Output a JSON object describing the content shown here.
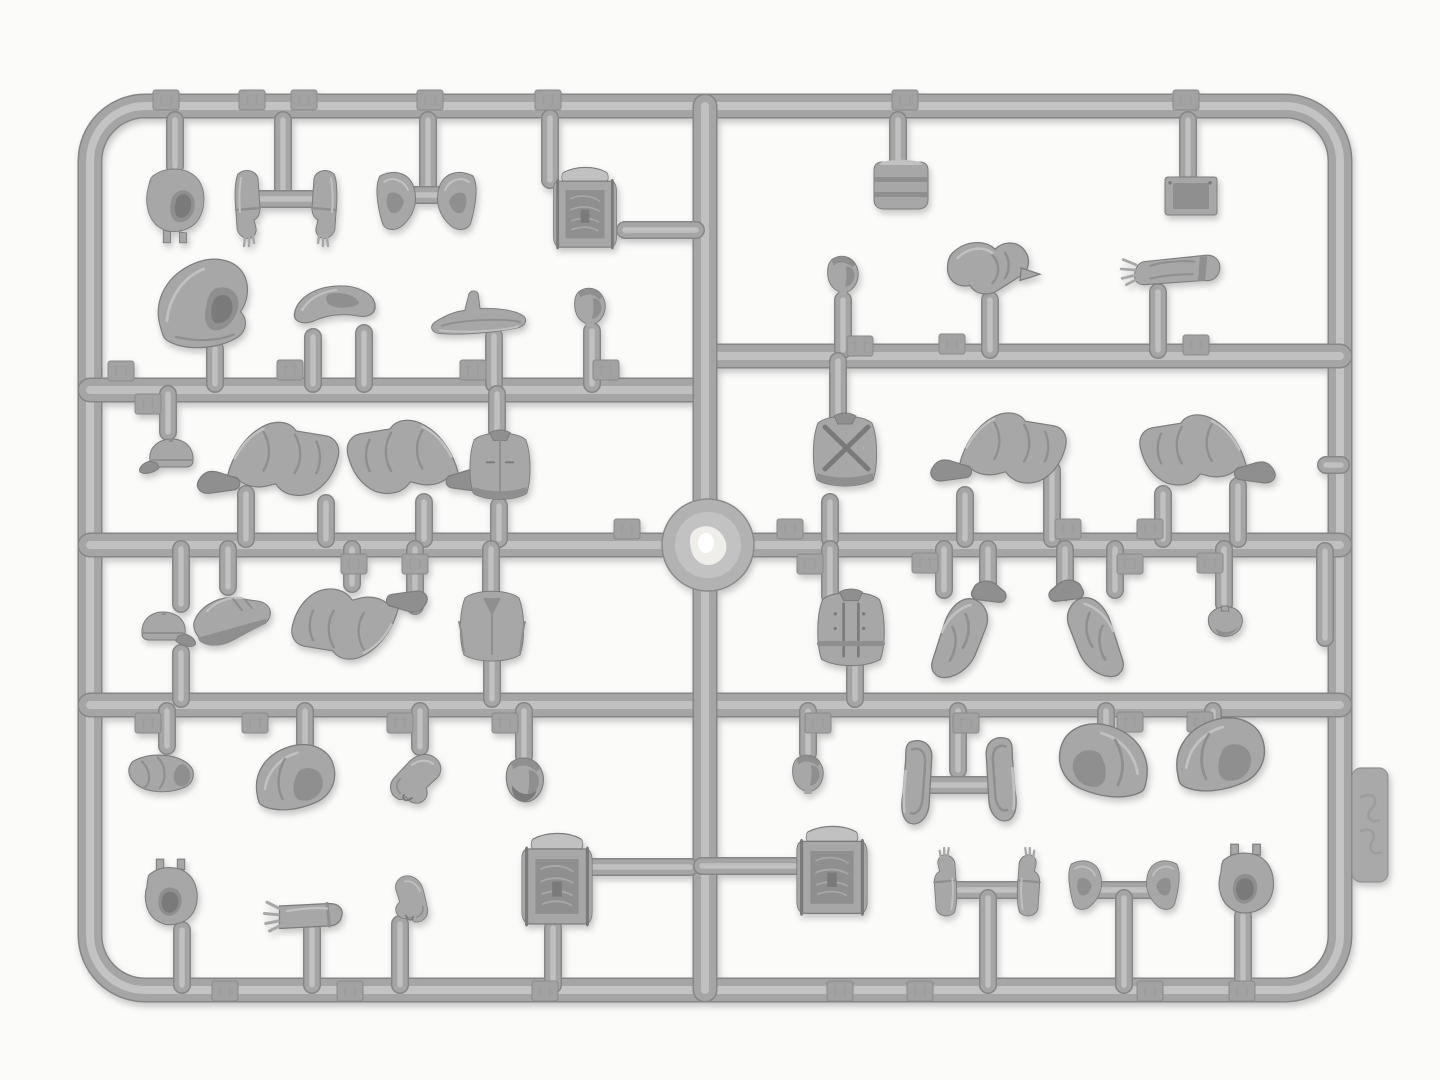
{
  "meta": {
    "alt": "Photograph of a gray injection-molded plastic model kit sprue holding miniature figure parts: balaclava heads, hoods, caps, arms, hands, bent legs, torsos, backpacks and equipment pieces, arranged in a rectangular runner frame on a white background",
    "subject": "plastic model kit parts sprue",
    "note": "embossed part-number tabs present on runners but digits are not legible in the photo"
  },
  "palette": {
    "background": "#fbfbfa",
    "bar_dark": "#868686",
    "bar_base": "#a5a5a5",
    "bar_light": "#c3c3c3",
    "part_base": "#a7a7a7",
    "part_shade": "#8f8f8f",
    "part_dark": "#7a7a7a",
    "part_light": "#c1c1c1",
    "part_outline": "#7c7c7c",
    "tab_fill": "#a2a2a2",
    "tab_edge": "#8a8a8a",
    "hub_fill": "#b2b2b2",
    "hub_ring": "#c2c2c2",
    "hub_bright": "#efeeea",
    "hub_white": "#ffffff",
    "side_tab_fill": "#a9a9a9",
    "side_tab_edge": "#919191",
    "emboss": "#9d9d9d"
  },
  "sprue": {
    "frame": {
      "x": 90,
      "y": 106,
      "w": 1250,
      "h": 884,
      "rx": 55,
      "bar_width": 22
    },
    "bars": [
      {
        "x1": 90,
        "y1": 390,
        "x2": 705,
        "y2": 390
      },
      {
        "x1": 705,
        "y1": 356,
        "x2": 1340,
        "y2": 356
      },
      {
        "x1": 90,
        "y1": 545,
        "x2": 1340,
        "y2": 545
      },
      {
        "x1": 90,
        "y1": 705,
        "x2": 1340,
        "y2": 705
      },
      {
        "x1": 705,
        "y1": 106,
        "x2": 705,
        "y2": 990
      }
    ],
    "hub": {
      "x": 708,
      "y": 545,
      "r": 46
    },
    "side_tab": {
      "x": 1352,
      "y": 768,
      "w": 36,
      "h": 114,
      "rx": 9
    },
    "stubs": [
      [
        175,
        120,
        175,
        166
      ],
      [
        283,
        120,
        283,
        197
      ],
      [
        245,
        199,
        323,
        199
      ],
      [
        428,
        120,
        428,
        192
      ],
      [
        396,
        195,
        458,
        195
      ],
      [
        550,
        118,
        550,
        180
      ],
      [
        625,
        230,
        696,
        230
      ],
      [
        215,
        349,
        215,
        384
      ],
      [
        313,
        337,
        313,
        384
      ],
      [
        364,
        333,
        364,
        384
      ],
      [
        494,
        336,
        494,
        384
      ],
      [
        592,
        331,
        592,
        384
      ],
      [
        898,
        120,
        898,
        160
      ],
      [
        1188,
        120,
        1188,
        174
      ],
      [
        843,
        300,
        843,
        350
      ],
      [
        990,
        300,
        990,
        350
      ],
      [
        1158,
        292,
        1158,
        350
      ],
      [
        168,
        394,
        168,
        432
      ],
      [
        497,
        394,
        497,
        431
      ],
      [
        246,
        494,
        246,
        539
      ],
      [
        326,
        503,
        326,
        539
      ],
      [
        424,
        502,
        424,
        539
      ],
      [
        499,
        506,
        499,
        539
      ],
      [
        838,
        361,
        838,
        416
      ],
      [
        830,
        502,
        830,
        539
      ],
      [
        965,
        495,
        965,
        539
      ],
      [
        1052,
        470,
        1052,
        539
      ],
      [
        1163,
        494,
        1163,
        539
      ],
      [
        1238,
        486,
        1238,
        539
      ],
      [
        1326,
        465,
        1341,
        465
      ],
      [
        181,
        549,
        181,
        604
      ],
      [
        181,
        653,
        181,
        699
      ],
      [
        228,
        549,
        228,
        587
      ],
      [
        352,
        549,
        352,
        584
      ],
      [
        415,
        549,
        415,
        606
      ],
      [
        491,
        549,
        491,
        597
      ],
      [
        492,
        659,
        492,
        699
      ],
      [
        830,
        549,
        830,
        596
      ],
      [
        855,
        663,
        855,
        699
      ],
      [
        944,
        549,
        944,
        590
      ],
      [
        988,
        549,
        988,
        592
      ],
      [
        1065,
        549,
        1065,
        592
      ],
      [
        1115,
        549,
        1115,
        590
      ],
      [
        1224,
        549,
        1224,
        604
      ],
      [
        1325,
        551,
        1325,
        638
      ],
      [
        167,
        711,
        167,
        746
      ],
      [
        305,
        711,
        305,
        750
      ],
      [
        420,
        711,
        420,
        747
      ],
      [
        524,
        711,
        524,
        756
      ],
      [
        182,
        930,
        182,
        985
      ],
      [
        312,
        929,
        312,
        985
      ],
      [
        400,
        924,
        400,
        985
      ],
      [
        553,
        928,
        553,
        985
      ],
      [
        592,
        867,
        690,
        867
      ],
      [
        808,
        711,
        808,
        753
      ],
      [
        958,
        711,
        958,
        770
      ],
      [
        930,
        785,
        988,
        785
      ],
      [
        1106,
        711,
        1106,
        740
      ],
      [
        1213,
        711,
        1213,
        737
      ],
      [
        702,
        866,
        795,
        866
      ],
      [
        958,
        890,
        1016,
        890
      ],
      [
        988,
        898,
        988,
        985
      ],
      [
        1098,
        890,
        1150,
        890
      ],
      [
        1124,
        898,
        1124,
        985
      ],
      [
        1243,
        916,
        1243,
        985
      ]
    ],
    "number_tabs": [
      [
        166,
        100
      ],
      [
        252,
        100
      ],
      [
        304,
        100
      ],
      [
        430,
        100
      ],
      [
        548,
        100
      ],
      [
        905,
        100
      ],
      [
        1186,
        100
      ],
      [
        121,
        371
      ],
      [
        290,
        370
      ],
      [
        473,
        370
      ],
      [
        606,
        370
      ],
      [
        148,
        404
      ],
      [
        860,
        346
      ],
      [
        952,
        344
      ],
      [
        1196,
        345
      ],
      [
        627,
        529
      ],
      [
        790,
        529
      ],
      [
        1068,
        529
      ],
      [
        1150,
        529
      ],
      [
        354,
        564
      ],
      [
        415,
        564
      ],
      [
        810,
        564
      ],
      [
        925,
        563
      ],
      [
        1130,
        564
      ],
      [
        1210,
        563
      ],
      [
        148,
        723
      ],
      [
        255,
        723
      ],
      [
        400,
        723
      ],
      [
        505,
        723
      ],
      [
        818,
        723
      ],
      [
        966,
        723
      ],
      [
        1130,
        722
      ],
      [
        1200,
        722
      ],
      [
        225,
        991
      ],
      [
        350,
        991
      ],
      [
        545,
        991
      ],
      [
        840,
        991
      ],
      [
        920,
        991
      ],
      [
        1150,
        991
      ],
      [
        1242,
        991
      ]
    ],
    "parts": [
      {
        "t": "balaclava",
        "x": 175,
        "y": 205,
        "s": 0.9,
        "label": "balaclava head"
      },
      {
        "t": "forearm",
        "x": 247,
        "y": 206,
        "label": "forearm with hand"
      },
      {
        "t": "forearm",
        "x": 325,
        "y": 206,
        "fx": 1,
        "label": "forearm with hand"
      },
      {
        "t": "gaiter",
        "x": 396,
        "y": 202,
        "label": "boot gaiter"
      },
      {
        "t": "gaiter",
        "x": 457,
        "y": 202,
        "fx": 1,
        "label": "boot gaiter"
      },
      {
        "t": "backpack",
        "x": 585,
        "y": 212,
        "sx": 0.72,
        "sy": 1.1,
        "label": "backpack"
      },
      {
        "t": "hood-big",
        "x": 206,
        "y": 307,
        "s": 1.15,
        "label": "hooded head"
      },
      {
        "t": "shoulder",
        "x": 336,
        "y": 306,
        "sx": 1.3,
        "sy": 1.0,
        "label": "shoulder yoke"
      },
      {
        "t": "saddle",
        "x": 480,
        "y": 318,
        "s": 0.95,
        "label": "saddle piece"
      },
      {
        "t": "head",
        "x": 590,
        "y": 308,
        "s": 0.95,
        "label": "head"
      },
      {
        "t": "drum",
        "x": 901,
        "y": 185,
        "label": "canteen drum"
      },
      {
        "t": "plate",
        "x": 1191,
        "y": 196,
        "label": "equipment plate"
      },
      {
        "t": "head",
        "x": 843,
        "y": 276,
        "s": 0.95,
        "label": "head"
      },
      {
        "t": "arm-point",
        "x": 995,
        "y": 273,
        "s": 1.25,
        "label": "pointing arm"
      },
      {
        "t": "arm-gauntlet",
        "x": 1182,
        "y": 270,
        "s": 1.05,
        "label": "gauntleted arm"
      },
      {
        "t": "cap",
        "x": 171,
        "y": 457,
        "label": "peaked cap"
      },
      {
        "t": "legs",
        "x": 278,
        "y": 461,
        "s": 1.2,
        "label": "bent legs"
      },
      {
        "t": "legs",
        "x": 408,
        "y": 459,
        "s": 1.2,
        "fx": 1,
        "label": "bent legs"
      },
      {
        "t": "torso-vest",
        "x": 500,
        "y": 468,
        "s": 0.95,
        "label": "torso"
      },
      {
        "t": "torso-straps",
        "x": 845,
        "y": 453,
        "label": "torso with cross straps"
      },
      {
        "t": "legs",
        "x": 1008,
        "y": 450,
        "s": 1.15,
        "label": "bent legs"
      },
      {
        "t": "legs",
        "x": 1198,
        "y": 452,
        "s": 1.15,
        "fx": 1,
        "label": "bent legs"
      },
      {
        "t": "cap",
        "x": 164,
        "y": 630,
        "fx": 1,
        "label": "peaked cap"
      },
      {
        "t": "boot",
        "x": 233,
        "y": 618,
        "s": 1.1,
        "r": -20,
        "label": "boot"
      },
      {
        "t": "legs",
        "x": 350,
        "y": 622,
        "s": 1.15,
        "r": 180,
        "label": "folded legs"
      },
      {
        "t": "torso-coat",
        "x": 492,
        "y": 628,
        "label": "torso in coat"
      },
      {
        "t": "torso-dbl",
        "x": 851,
        "y": 631,
        "s": 1.05,
        "label": "double-breasted torso"
      },
      {
        "t": "legs-v",
        "x": 968,
        "y": 632,
        "s": 1.3,
        "label": "folded legs"
      },
      {
        "t": "legs-v",
        "x": 1087,
        "y": 631,
        "s": 1.3,
        "fx": 1,
        "label": "folded legs"
      },
      {
        "t": "beret",
        "x": 1225,
        "y": 622,
        "label": "beret"
      },
      {
        "t": "roll",
        "x": 162,
        "y": 775,
        "s": 1.1,
        "label": "rolled cap"
      },
      {
        "t": "hood-small",
        "x": 295,
        "y": 784,
        "s": 1.25,
        "label": "hood"
      },
      {
        "t": "arm-bent",
        "x": 420,
        "y": 779,
        "label": "bent arm"
      },
      {
        "t": "head-beard",
        "x": 525,
        "y": 782,
        "s": 1.15,
        "label": "bearded head"
      },
      {
        "t": "balaclava-open",
        "x": 170,
        "y": 899,
        "s": 1.05,
        "label": "balaclava open face"
      },
      {
        "t": "hand-arm",
        "x": 312,
        "y": 916,
        "s": 1.25,
        "label": "forearm with hand"
      },
      {
        "t": "arm-bent",
        "x": 408,
        "y": 898,
        "s": 0.85,
        "r": 30,
        "fx": 1,
        "label": "bent arm"
      },
      {
        "t": "backpack",
        "x": 557,
        "y": 884,
        "sx": 0.8,
        "sy": 1.25,
        "label": "backpack"
      },
      {
        "t": "head",
        "x": 808,
        "y": 775,
        "s": 0.95,
        "label": "head"
      },
      {
        "t": "panel",
        "x": 920,
        "y": 783,
        "sx": 1.3,
        "sy": 1.2,
        "label": "coat flap"
      },
      {
        "t": "panel",
        "x": 998,
        "y": 780,
        "sx": 1.3,
        "sy": 1.2,
        "fx": 1,
        "label": "coat flap"
      },
      {
        "t": "hood-small",
        "x": 1104,
        "y": 768,
        "s": 1.4,
        "fx": 1,
        "label": "hood"
      },
      {
        "t": "hood-small",
        "x": 1220,
        "y": 762,
        "s": 1.4,
        "label": "hood"
      },
      {
        "t": "backpack",
        "x": 832,
        "y": 875,
        "sx": 0.8,
        "sy": 1.2,
        "label": "rucksack"
      },
      {
        "t": "forearm",
        "x": 946,
        "y": 884,
        "s": 0.9,
        "r": 180,
        "label": "raised hand"
      },
      {
        "t": "forearm",
        "x": 1028,
        "y": 884,
        "s": 0.9,
        "r": 180,
        "fx": 1,
        "label": "raised hand"
      },
      {
        "t": "gaiter",
        "x": 1085,
        "y": 886,
        "s": 0.85,
        "label": "boot cuff"
      },
      {
        "t": "gaiter",
        "x": 1163,
        "y": 886,
        "s": 0.85,
        "fx": 1,
        "label": "boot cuff"
      },
      {
        "t": "balaclava-open",
        "x": 1245,
        "y": 886,
        "s": 1.1,
        "label": "balaclava open face"
      }
    ]
  }
}
